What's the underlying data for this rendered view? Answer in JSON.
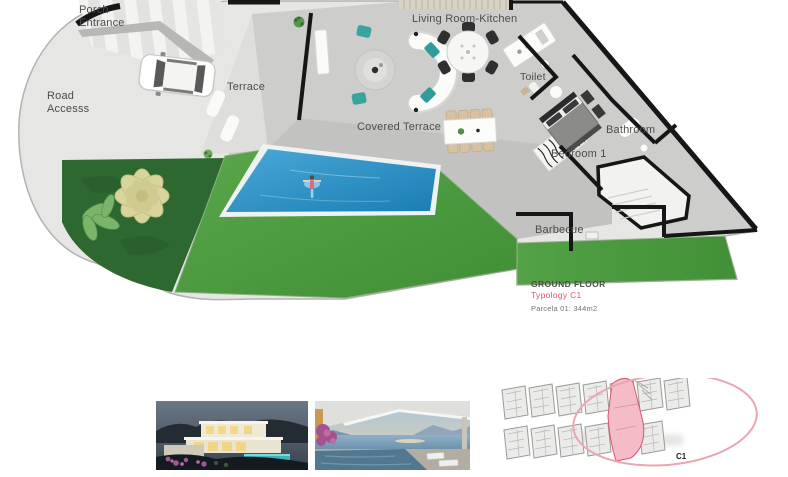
{
  "plan": {
    "labels": {
      "porch_entrance": "Porch Entrance",
      "living_room_kitchen": "Living Room-Kitchen",
      "road_access": "Road Accesss",
      "terrace": "Terrace",
      "covered_terrace": "Covered Terrace",
      "toilet": "Toilet",
      "bathroom": "Bathroom",
      "bedroom_1": "Bedroom 1",
      "barbecue": "Barbecue"
    },
    "legend": {
      "floor": "GROUND FLOOR",
      "typology": "Typology C1",
      "parcela": "Parcela 01: 344m2"
    },
    "colors": {
      "pool_blue": "#2f95c6",
      "lawn_green": "#4f9e41",
      "garden_dark_green": "#2d6831",
      "typology_pink": "#e0566b",
      "wall_black": "#161616"
    }
  },
  "site_plan": {
    "highlight_label": "C1",
    "highlight_color": "#f4bcc6"
  },
  "thumbnails": [
    {
      "name": "villa-exterior-dusk"
    },
    {
      "name": "covered-terrace-sea-view"
    }
  ]
}
